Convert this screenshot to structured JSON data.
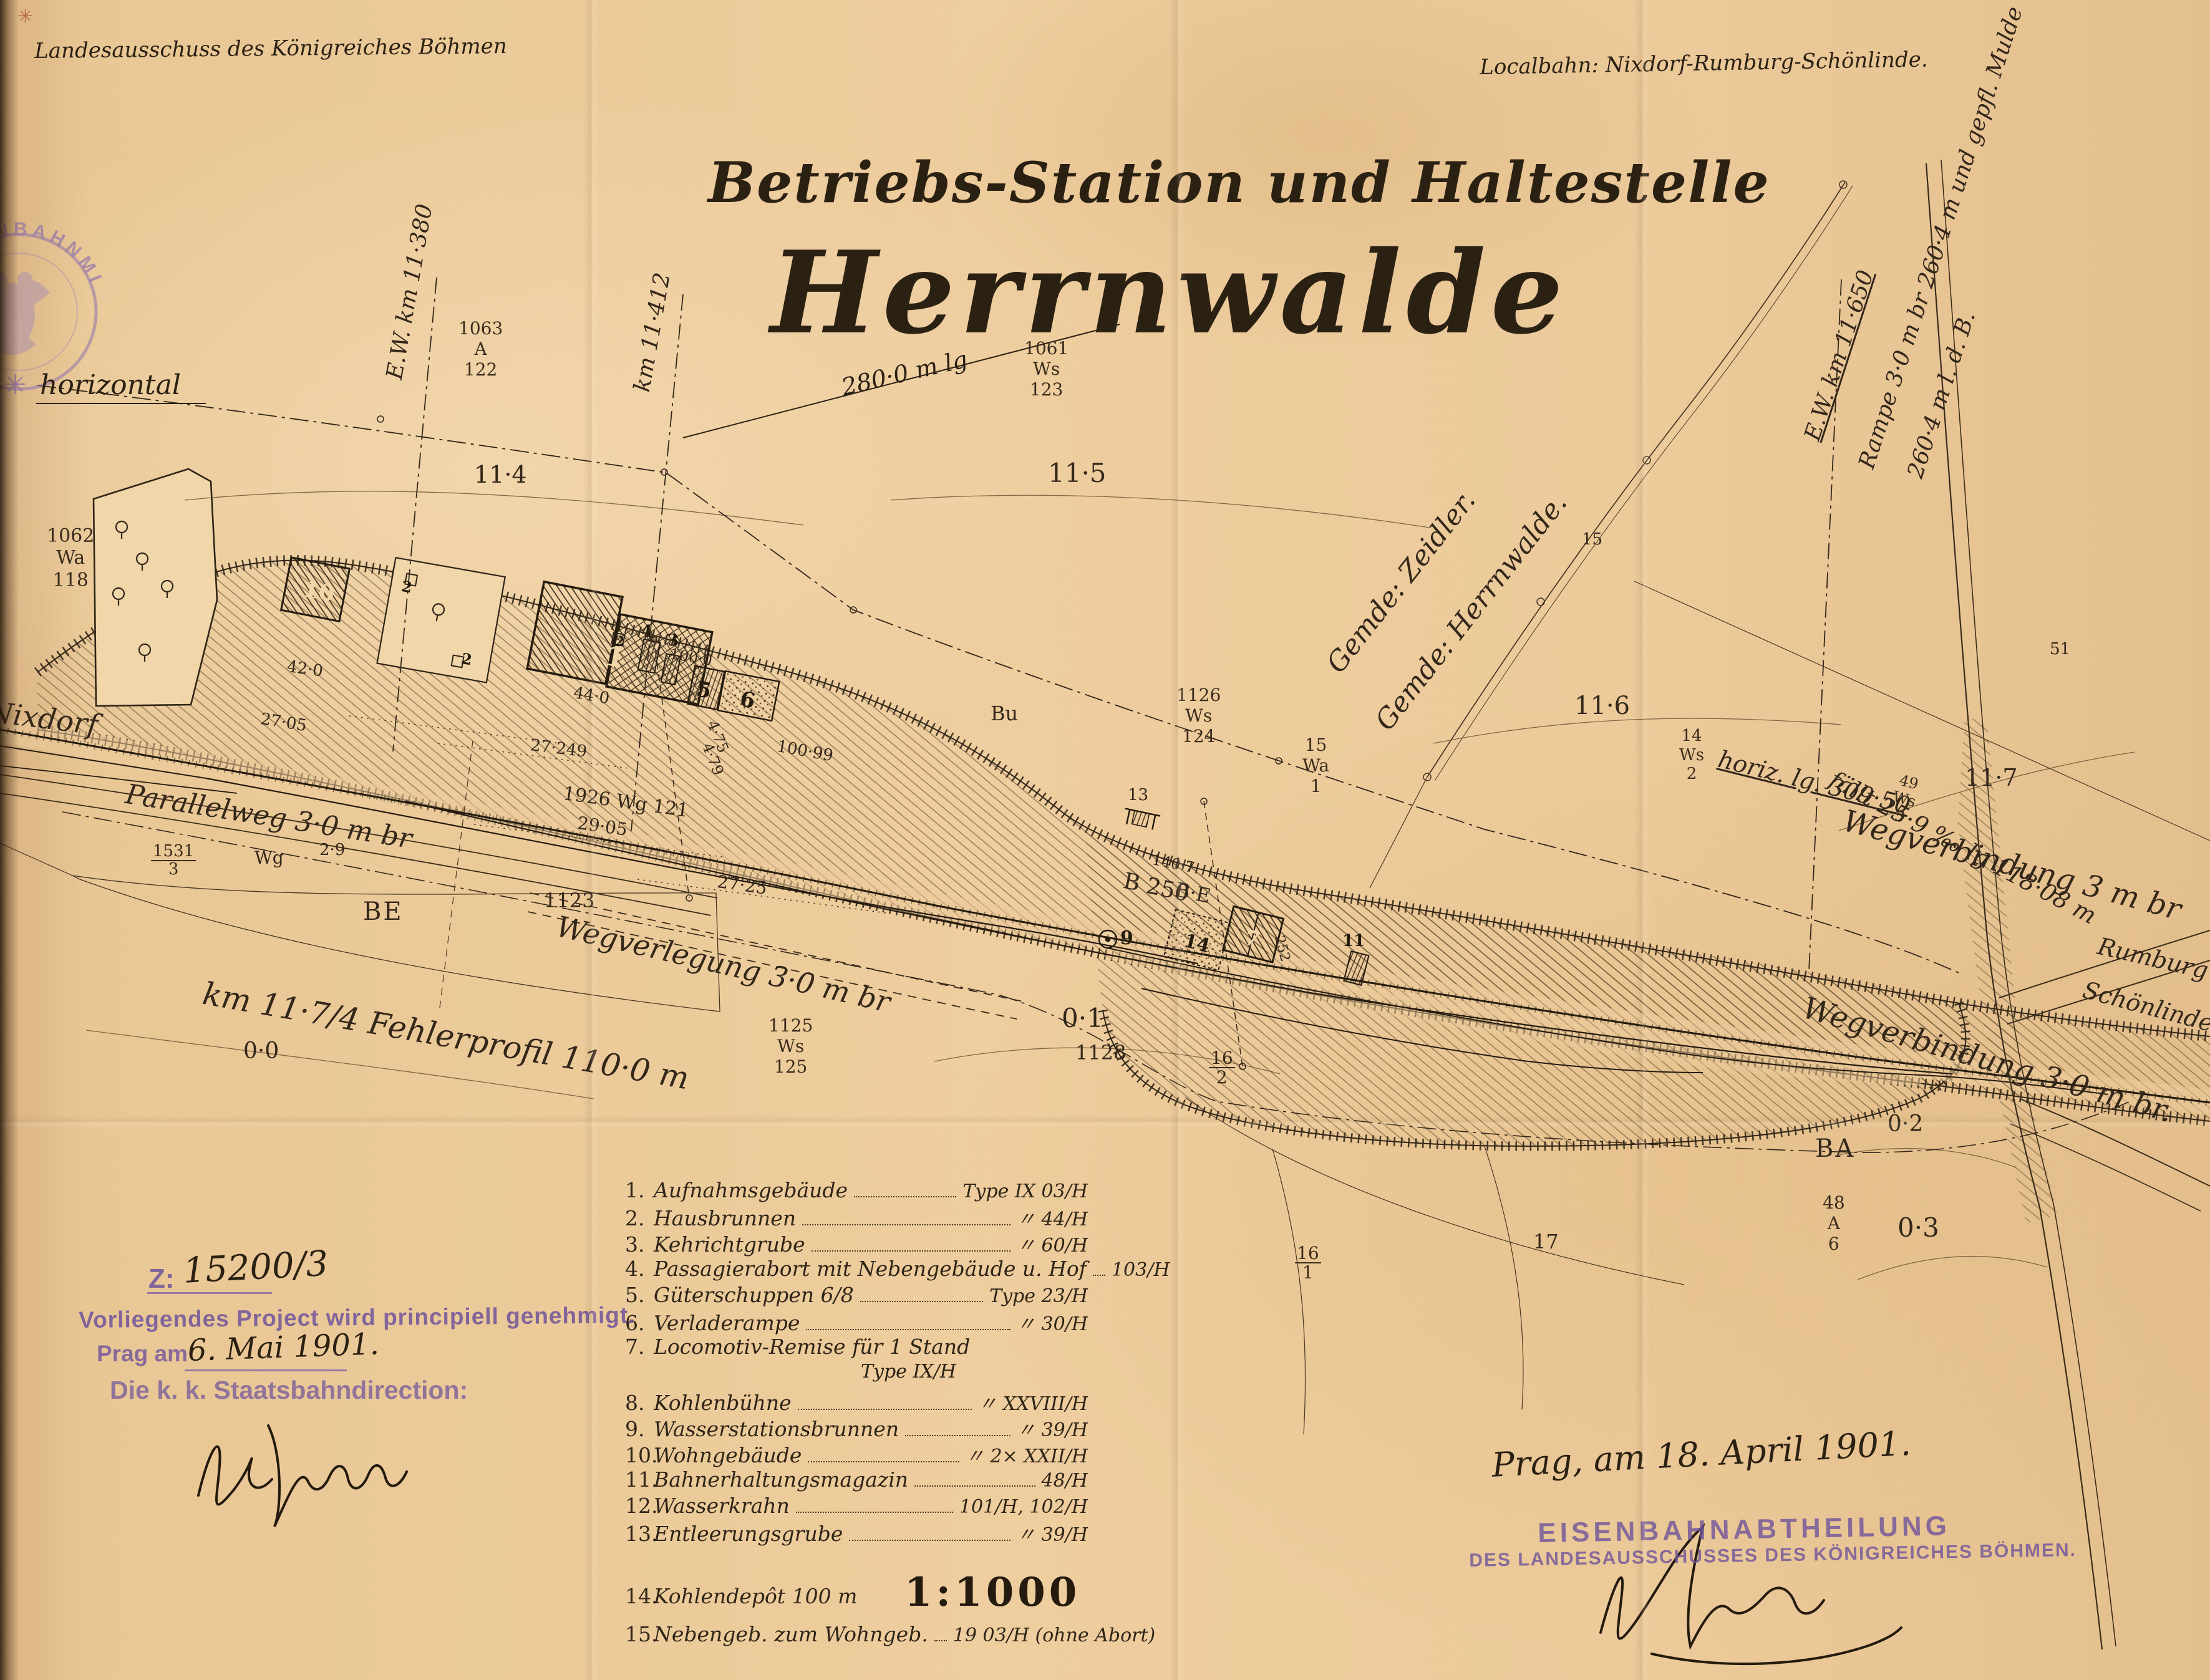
{
  "header": {
    "left": "Landesausschuss des Königreiches Böhmen",
    "right": "Localbahn: Nixdorf-Rumburg-Schönlinde."
  },
  "title": {
    "line1": "Betriebs-Station und Haltestelle",
    "line2": "Herrnwalde",
    "length_note": "280·0 m lg"
  },
  "stamps": {
    "ministry_arc": "EISENBAHNMINISTERIUM",
    "left_block": {
      "z_prefix": "Z:",
      "file_number": "15200/3",
      "line1": "Vorliegendes Project wird principiell genehmigt.",
      "line2_prefix": "Prag am",
      "line2_date": "6. Mai 1901.",
      "line3": "Die k. k. Staatsbahndirection:"
    },
    "right_block": {
      "date_line": "Prag, am 18. April 1901.",
      "stamp_line1": "EISENBAHNABTHEILUNG",
      "stamp_line2": "DES LANDESAUSSCHUSSES DES KÖNIGREICHES BÖHMEN."
    }
  },
  "legend": {
    "items": [
      {
        "num": "1.",
        "label": "Aufnahmsgebäude",
        "value": "Type IX 03/H"
      },
      {
        "num": "2.",
        "label": "Hausbrunnen",
        "value": "〃 44/H"
      },
      {
        "num": "3.",
        "label": "Kehrichtgrube",
        "value": "〃 60/H"
      },
      {
        "num": "4.",
        "label": "Passagierabort mit Nebengebäude u. Hof",
        "value": "103/H"
      },
      {
        "num": "5.",
        "label": "Güterschuppen 6/8",
        "value": "Type 23/H"
      },
      {
        "num": "6.",
        "label": "Verladerampe",
        "value": "〃 30/H"
      },
      {
        "num": "7.",
        "label": "Locomotiv-Remise für 1 Stand",
        "value": "Type IX/H"
      },
      {
        "num": "8.",
        "label": "Kohlenbühne",
        "value": "〃 XXVIII/H"
      },
      {
        "num": "9.",
        "label": "Wasserstationsbrunnen",
        "value": "〃 39/H"
      },
      {
        "num": "10.",
        "label": "Wohngebäude",
        "value": "〃 2× XXII/H"
      },
      {
        "num": "11.",
        "label": "Bahnerhaltungsmagazin",
        "value": "48/H"
      },
      {
        "num": "12.",
        "label": "Wasserkrahn",
        "value": "101/H, 102/H"
      },
      {
        "num": "13.",
        "label": "Entleerungsgrube",
        "value": "〃 39/H"
      },
      {
        "num": "14.",
        "label": "Kohlendepôt 100 m",
        "value": ""
      },
      {
        "num": "15.",
        "label": "Nebengeb. zum Wohngeb.",
        "value": "19 03/H (ohne Abort)"
      }
    ],
    "scale": "1:1000"
  },
  "map": {
    "horizontal": "horizontal",
    "nixdorf": "Nixdorf",
    "parallelweg": "Parallelweg 3·0 m br",
    "fehlerprofil": "km 11·7/4 Fehlerprofil 110·0 m",
    "wegverlegung": "Wegverlegung 3·0 m br",
    "wegverb_oben": "Wegverbindung 3 m br",
    "wegverb_unten": "Wegverbindung 3·0 m br.",
    "gem_zeidler": "Gemde: Zeidler.",
    "gem_herrnwalde": "Gemde: Herrnwalde.",
    "ew_11380": "E.W. km 11·380",
    "km_11412": "km 11·412",
    "ew_11650": "E.W. km 11·650",
    "rampe1": "Rampe 3·0 m br 260·4 m und gepfl. Mulde",
    "rampe2": "260·4 m l. d. B.",
    "horiz_lg": "horiz. lg. 309·50",
    "faellt": "fällt 25·9 ‰ lg 118·08 m",
    "rumburg": "Rumburg",
    "schoenlinde": "Schönlinde",
    "be": "BE",
    "ba": "BA",
    "bu": "Bu",
    "b250": "B 250",
    "be2": "B·E",
    "c11_4": "11·4",
    "c11_5": "11·5",
    "c11_6": "11·6",
    "c11_7": "11·7",
    "c0_0": "0·0",
    "c0_1": "0·1",
    "c0_2": "0·2",
    "c0_3": "0·3",
    "wg": "Wg",
    "v2_9": "2·9",
    "v27_05": "27·05",
    "v27_249": "27·249",
    "v29_05": "29·05",
    "v27_25": "27·25",
    "v42_0": "42·0",
    "v44_0": "44·0",
    "v100_0": "100·0",
    "v100_99": "100·99",
    "v4_75": "4·75",
    "v4_79": "4·79",
    "v140_7": "140·7",
    "v252": "252",
    "v1926": "1926  Wg  121",
    "v51": "51",
    "v13t": "13",
    "v15": "15",
    "v17": "17",
    "parcel_1123": "1123",
    "parcel_1128": "1128",
    "parcel_1531": {
      "lines": [
        "1531",
        "3"
      ]
    },
    "parcel_1062": {
      "lines": [
        "1062",
        "Wa",
        "118"
      ]
    },
    "parcel_1063": {
      "lines": [
        "1063",
        "A",
        "122"
      ]
    },
    "parcel_1061": {
      "lines": [
        "1061",
        "Ws",
        "123"
      ]
    },
    "parcel_1125": {
      "lines": [
        "1125",
        "Ws",
        "125"
      ]
    },
    "parcel_1126": {
      "lines": [
        "1126",
        "Ws",
        "124"
      ]
    },
    "parcel_15wa": {
      "lines": [
        "15",
        "Wa",
        "1"
      ]
    },
    "parcel_14ws": {
      "lines": [
        "14",
        "Ws",
        "2"
      ]
    },
    "parcel_49": {
      "lines": [
        "49",
        "Ws",
        "5"
      ]
    },
    "parcel_48": {
      "lines": [
        "48",
        "A",
        "6"
      ]
    },
    "parcel_16_2": {
      "lines": [
        "16",
        "2"
      ]
    },
    "parcel_16_1": {
      "lines": [
        "16",
        "1"
      ]
    },
    "bld": {
      "n1": "1",
      "n2": "2",
      "n3": "3",
      "n4": "4",
      "n5": "5",
      "n6": "6",
      "n7": "7",
      "n9": "9",
      "n10": "10",
      "n11": "11",
      "n13": "13",
      "n14": "14"
    }
  },
  "colors": {
    "paper": "#ecca9a",
    "ink": "#2b2113",
    "stamp_purple": "#6f549b",
    "stamp_faded": "#8a6fae"
  }
}
